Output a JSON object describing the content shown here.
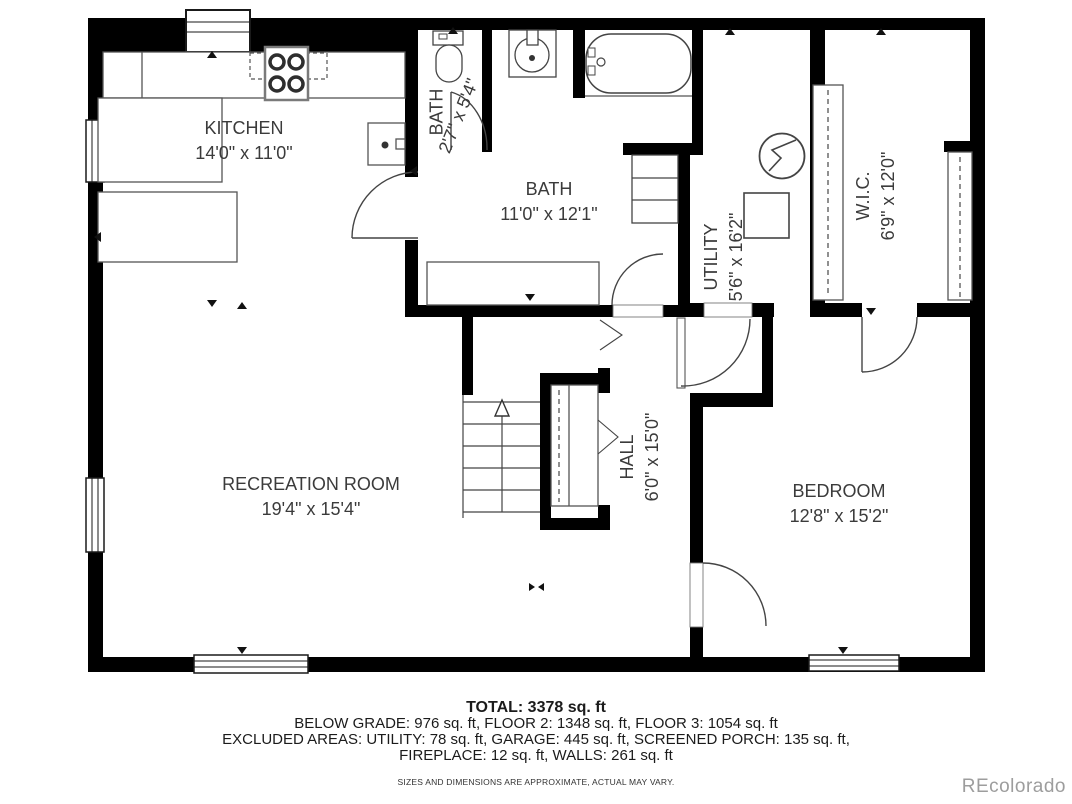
{
  "rooms": {
    "kitchen": {
      "name": "KITCHEN",
      "dims": "14'0\" x 11'0\""
    },
    "bath_small": {
      "name": "BATH",
      "dims": "2'7\" x 5'4\""
    },
    "bath": {
      "name": "BATH",
      "dims": "11'0\" x 12'1\""
    },
    "utility": {
      "name": "UTILITY",
      "dims": "5'6\" x 16'2\""
    },
    "wic": {
      "name": "W.I.C.",
      "dims": "6'9\" x 12'0\""
    },
    "hall": {
      "name": "HALL",
      "dims": "6'0\" x 15'0\""
    },
    "recreation": {
      "name": "RECREATION ROOM",
      "dims": "19'4\" x 15'4\""
    },
    "bedroom": {
      "name": "BEDROOM",
      "dims": "12'8\" x 15'2\""
    }
  },
  "summary": {
    "total": "TOTAL: 3378 sq. ft",
    "line2": "BELOW GRADE: 976 sq. ft, FLOOR 2: 1348 sq. ft, FLOOR 3: 1054 sq. ft",
    "line3": "EXCLUDED AREAS: UTILITY: 78 sq. ft, GARAGE: 445 sq. ft, SCREENED PORCH: 135 sq. ft,",
    "line4": "FIREPLACE: 12 sq. ft, WALLS: 261 sq. ft",
    "disclaimer": "SIZES AND DIMENSIONS ARE APPROXIMATE, ACTUAL MAY VARY."
  },
  "watermark": "REcolorado",
  "colors": {
    "wall": "#000000",
    "line": "#3f3f3f",
    "text": "#3b3b3b",
    "watermark": "#9d9d9d"
  }
}
